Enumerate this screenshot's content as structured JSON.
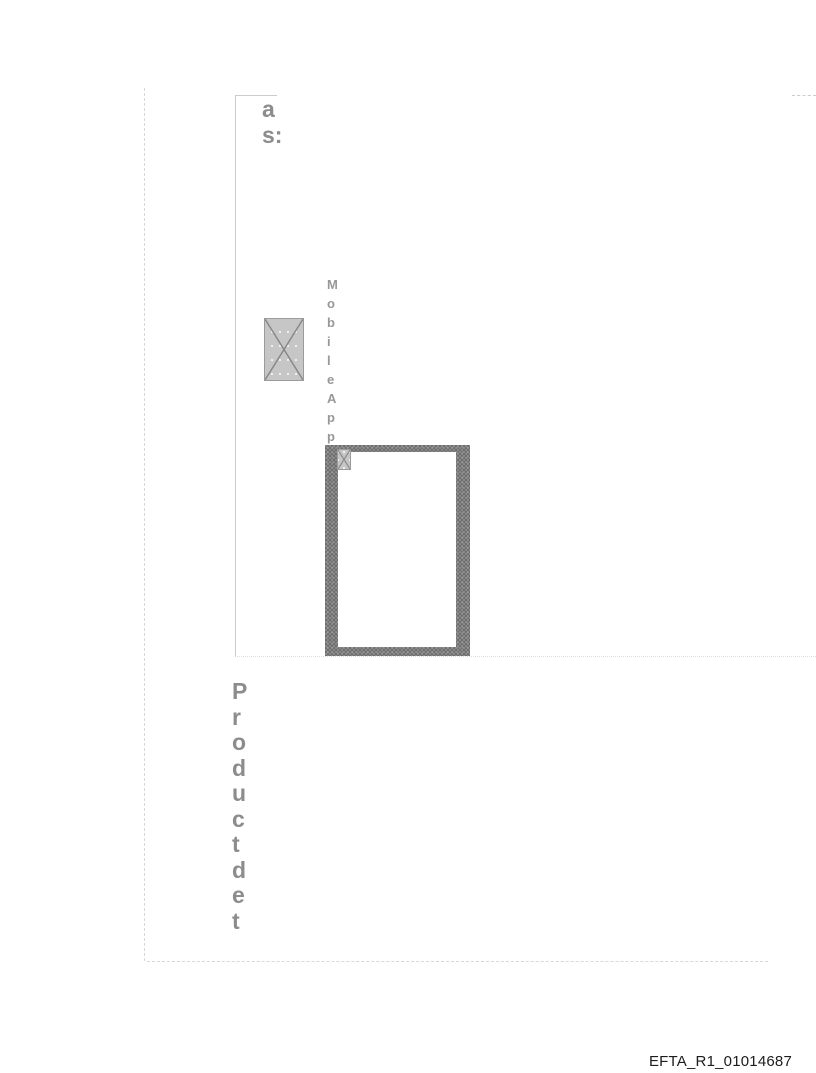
{
  "page": {
    "background": "#ffffff"
  },
  "content": {
    "truncated_label": "as:",
    "broken_image_alt": "Mobile App",
    "section_heading": "Product det",
    "footer_code": "EFTA_R1_01014687"
  },
  "icons": {
    "large_placeholder": "broken-image-icon",
    "small_placeholder": "broken-image-icon"
  },
  "colors": {
    "vertical_text": "#8c8c8c",
    "alt_text": "#989898",
    "footer_text": "#1c1c1c",
    "placeholder_fill": "#c6c6c6",
    "placeholder_line": "#868686",
    "frame_dark": "#6e6e6e",
    "frame_light": "#888888",
    "guide_solid": "#cccccc",
    "guide_dashed": "#d8d8d8",
    "guide_dotted": "#dddddd"
  }
}
